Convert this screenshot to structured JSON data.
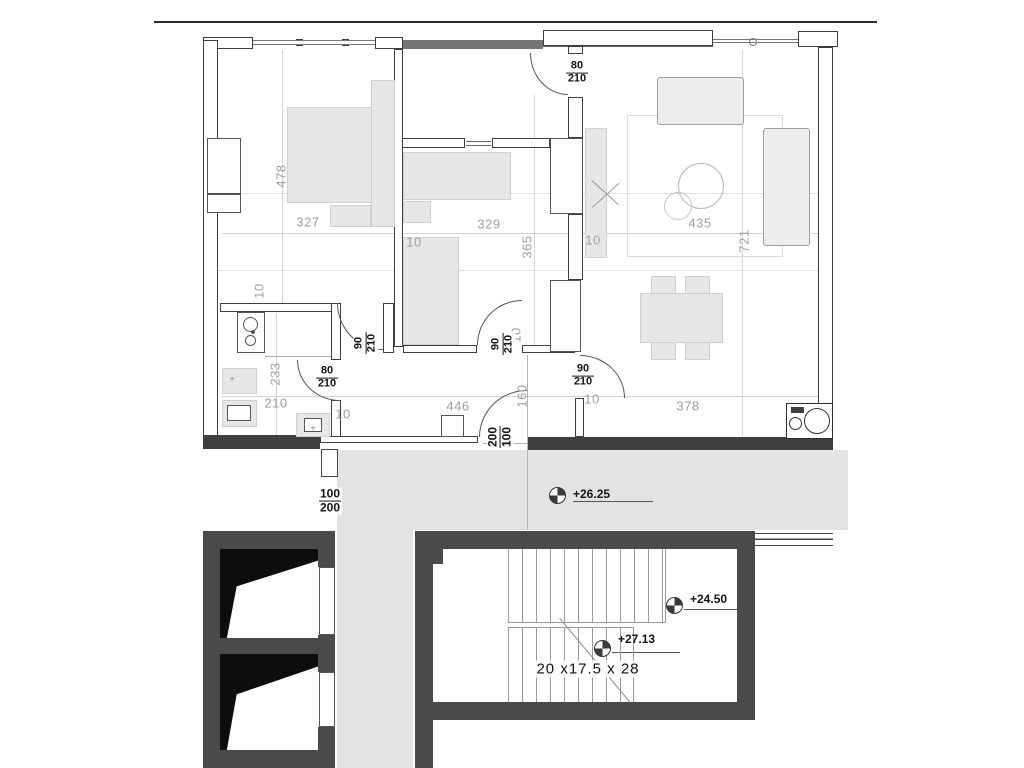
{
  "drawing": {
    "type": "apartment-floor-plan-with-staircase",
    "colors": {
      "background": "#ffffff",
      "wall_dark": "#4a4a4a",
      "wall_line": "#3d3d3d",
      "corridor_gray": "#e3e3e3",
      "furniture_gray": "#e7e7e7",
      "dim_text": "#9e9e9e",
      "label_text": "#141414"
    },
    "stair_text": "20 x17.5 x 28",
    "elevations": [
      "+26.25",
      "+24.50",
      "+27.13"
    ],
    "room_dimensions": [
      "478",
      "327",
      "329",
      "365",
      "435",
      "721",
      "233",
      "210",
      "446",
      "378",
      "160",
      "10"
    ],
    "door_sizes": [
      "80/210",
      "90/210"
    ],
    "window_sizes": [
      "100/200",
      "200/100"
    ]
  },
  "plan": {
    "areas": [
      [
        337,
        450,
        511,
        80
      ],
      [
        337,
        530,
        76,
        238
      ]
    ],
    "rects": [
      [
        "w",
        203,
        37,
        50,
        12
      ],
      [
        "w",
        375,
        37,
        28,
        12
      ],
      [
        "d2",
        403,
        40,
        140,
        9
      ],
      [
        "w",
        543,
        30,
        170,
        16
      ],
      [
        "w",
        798,
        31,
        40,
        16
      ],
      [
        "w",
        296,
        39,
        7,
        7
      ],
      [
        "w",
        342,
        39,
        7,
        7
      ],
      [
        "glz",
        253,
        40,
        122,
        5
      ],
      [
        "glz",
        713,
        39,
        85,
        4
      ],
      [
        "w",
        203,
        40,
        15,
        408
      ],
      [
        "w",
        818,
        47,
        15,
        390
      ],
      [
        "d3",
        203,
        435,
        117,
        14
      ],
      [
        "iw",
        320,
        436,
        158,
        7
      ],
      [
        "ow",
        441,
        415,
        23,
        22
      ],
      [
        "d3",
        528,
        437,
        305,
        13
      ],
      [
        "win3",
        321,
        449,
        17,
        28
      ],
      [
        "iw",
        394,
        49,
        9,
        298
      ],
      [
        "iw",
        220,
        303,
        118,
        9
      ],
      [
        "iw",
        383,
        303,
        11,
        50
      ],
      [
        "iw",
        403,
        345,
        74,
        8
      ],
      [
        "iw",
        522,
        345,
        53,
        8
      ],
      [
        "iw",
        568,
        46,
        15,
        8
      ],
      [
        "iw",
        568,
        97,
        15,
        41
      ],
      [
        "iw",
        568,
        214,
        15,
        66
      ],
      [
        "iw",
        575,
        398,
        9,
        39
      ],
      [
        "iw",
        402,
        138,
        63,
        10
      ],
      [
        "iw",
        492,
        138,
        58,
        10
      ],
      [
        "iw",
        331,
        303,
        10,
        57
      ],
      [
        "iw",
        331,
        400,
        10,
        37
      ],
      [
        "ow",
        237,
        312,
        28,
        41
      ],
      [
        "f",
        287,
        107,
        106,
        96
      ],
      [
        "f",
        371,
        80,
        24,
        147
      ],
      [
        "f",
        330,
        205,
        41,
        22
      ],
      [
        "ow",
        207,
        138,
        34,
        56
      ],
      [
        "ow",
        207,
        194,
        34,
        19
      ],
      [
        "f",
        403,
        152,
        108,
        48
      ],
      [
        "f",
        403,
        201,
        28,
        22
      ],
      [
        "f",
        403,
        237,
        56,
        108
      ],
      [
        "ow",
        550,
        138,
        33,
        76
      ],
      [
        "ow",
        550,
        280,
        31,
        72
      ],
      [
        "ol",
        627,
        115,
        156,
        142
      ],
      [
        "fo",
        657,
        77,
        87,
        48
      ],
      [
        "fo",
        763,
        128,
        47,
        118
      ],
      [
        "f",
        585,
        128,
        22,
        130
      ],
      [
        "f",
        640,
        293,
        83,
        50
      ],
      [
        "f",
        651,
        276,
        25,
        18
      ],
      [
        "f",
        685,
        276,
        25,
        18
      ],
      [
        "f",
        651,
        342,
        25,
        18
      ],
      [
        "f",
        685,
        342,
        25,
        18
      ],
      [
        "f",
        222,
        368,
        35,
        26
      ],
      [
        "f",
        222,
        400,
        35,
        27
      ],
      [
        "ow",
        227,
        405,
        24,
        16
      ],
      [
        "f",
        296,
        413,
        34,
        24
      ],
      [
        "ow",
        304,
        418,
        18,
        14
      ],
      [
        "ow2",
        786,
        403,
        47,
        36
      ],
      [
        "d3",
        791,
        407,
        13,
        6
      ],
      [
        "dk",
        203,
        531,
        132,
        18
      ],
      [
        "dk",
        203,
        549,
        17,
        219
      ],
      [
        "dk",
        203,
        638,
        132,
        16
      ],
      [
        "dk",
        203,
        750,
        132,
        18
      ],
      [
        "dk",
        318,
        549,
        17,
        18
      ],
      [
        "dk",
        318,
        635,
        17,
        37
      ],
      [
        "dk",
        318,
        727,
        17,
        41
      ],
      [
        "ow",
        319,
        567,
        16,
        68
      ],
      [
        "ow",
        319,
        672,
        16,
        55
      ],
      [
        "dk",
        415,
        531,
        340,
        18
      ],
      [
        "dk",
        415,
        549,
        18,
        219
      ],
      [
        "dk",
        737,
        549,
        18,
        171
      ],
      [
        "dk",
        415,
        702,
        340,
        18
      ],
      [
        "dk",
        433,
        549,
        10,
        15
      ],
      [
        "rail",
        755,
        533,
        78,
        13
      ]
    ],
    "flights": [
      [
        508,
        549,
        158,
        73
      ],
      [
        508,
        628,
        126,
        74
      ]
    ],
    "shafts": [
      [
        220,
        549,
        98,
        89
      ],
      [
        220,
        654,
        98,
        96
      ]
    ],
    "lines": [
      [
        154,
        21,
        723,
        2,
        "#2b2b2b"
      ],
      [
        203,
        193,
        630,
        1,
        "#e0e0e0"
      ],
      [
        203,
        270,
        630,
        1,
        "#e0e0e0"
      ],
      [
        222,
        233,
        596,
        1,
        "#d4d4d4"
      ],
      [
        222,
        396,
        596,
        1,
        "#d4d4d4"
      ],
      [
        282,
        50,
        1,
        253,
        "#d4d4d4"
      ],
      [
        534,
        95,
        1,
        250,
        "#d4d4d4"
      ],
      [
        742,
        50,
        1,
        385,
        "#d4d4d4"
      ],
      [
        276,
        313,
        1,
        122,
        "#d4d4d4"
      ],
      [
        527,
        355,
        1,
        175,
        "#b5b5b5"
      ],
      [
        329,
        450,
        1,
        26,
        "#555"
      ],
      [
        210,
        49,
        1,
        396,
        "#999"
      ],
      [
        543,
        46,
        170,
        1,
        "#666"
      ],
      [
        466,
        141,
        25,
        1,
        "#666"
      ],
      [
        466,
        145,
        25,
        1,
        "#666"
      ],
      [
        551,
        175,
        31,
        1,
        "#888"
      ],
      [
        700,
        80,
        1,
        42,
        "#b5b5b5"
      ],
      [
        763,
        167,
        44,
        1,
        "#b5b5b5"
      ],
      [
        763,
        206,
        44,
        1,
        "#b5b5b5"
      ],
      [
        404,
        318,
        54,
        1,
        "#cccccc"
      ],
      [
        265,
        356,
        66,
        1,
        "#aaaaaa"
      ],
      [
        592,
        155,
        2,
        68,
        "#777"
      ],
      [
        508,
        622,
        158,
        1,
        "#9a9a9a"
      ],
      [
        508,
        627,
        126,
        1,
        "#9a9a9a"
      ],
      [
        573,
        501,
        80,
        1,
        "#555"
      ],
      [
        684,
        609,
        53,
        1,
        "#555"
      ],
      [
        612,
        652,
        68,
        1,
        "#555"
      ],
      [
        483,
        443,
        45,
        1,
        "#b5b5b5"
      ],
      [
        326,
        568,
        1,
        66,
        "#555"
      ],
      [
        326,
        673,
        1,
        53,
        "#555"
      ]
    ],
    "rot_lines": [
      [
        560,
        618,
        110,
        50,
        "#8a8a8a"
      ],
      [
        592,
        180,
        36,
        42,
        "#999"
      ],
      [
        592,
        207,
        36,
        -42,
        "#999"
      ]
    ],
    "circles": [
      [
        678,
        163,
        46,
        "#b8b8b8"
      ],
      [
        664,
        192,
        28,
        "#c5c5c5"
      ],
      [
        243,
        317,
        15,
        "#555"
      ],
      [
        245,
        335,
        11,
        "#555"
      ],
      [
        251,
        330,
        4,
        "#555",
        "#555"
      ],
      [
        749,
        38,
        8,
        "#777"
      ],
      [
        804,
        408,
        26,
        "#333"
      ],
      [
        789,
        417,
        13,
        "#333"
      ]
    ],
    "arcs": [
      [
        530,
        53,
        38,
        42,
        "bl"
      ],
      [
        337,
        303,
        46,
        47,
        "bl"
      ],
      [
        297,
        360,
        43,
        41,
        "bl"
      ],
      [
        477,
        300,
        45,
        45,
        "tl"
      ],
      [
        479,
        390,
        48,
        47,
        "tl"
      ],
      [
        580,
        355,
        45,
        43,
        "tr"
      ]
    ],
    "markers": [
      [
        549,
        487
      ],
      [
        666,
        597
      ],
      [
        594,
        640
      ]
    ],
    "labels": [
      {
        "t": "478",
        "x": 281,
        "y": 176,
        "r": 1
      },
      {
        "t": "327",
        "x": 308,
        "y": 222
      },
      {
        "t": "329",
        "x": 489,
        "y": 224
      },
      {
        "t": "365",
        "x": 527,
        "y": 247,
        "r": 1
      },
      {
        "t": "435",
        "x": 700,
        "y": 223
      },
      {
        "t": "721",
        "x": 744,
        "y": 241,
        "r": 1
      },
      {
        "t": "233",
        "x": 275,
        "y": 374,
        "r": 1
      },
      {
        "t": "210",
        "x": 276,
        "y": 403
      },
      {
        "t": "446",
        "x": 458,
        "y": 406
      },
      {
        "t": "378",
        "x": 688,
        "y": 406
      },
      {
        "t": "160",
        "x": 522,
        "y": 396,
        "r": 1
      },
      {
        "t": "10",
        "x": 259,
        "y": 291,
        "r": 1
      },
      {
        "t": "10",
        "x": 414,
        "y": 242
      },
      {
        "t": "10",
        "x": 593,
        "y": 240
      },
      {
        "t": "10",
        "x": 516,
        "y": 335,
        "r": 1
      },
      {
        "t": "10",
        "x": 343,
        "y": 414
      },
      {
        "t": "10",
        "x": 592,
        "y": 399
      },
      {
        "t": "+",
        "x": 232,
        "y": 380,
        "c": "plus"
      },
      {
        "t": "+",
        "x": 313,
        "y": 429,
        "c": "plus"
      }
    ],
    "fracs": [
      {
        "a": "80",
        "b": "210",
        "x": 577,
        "y": 73
      },
      {
        "a": "80",
        "b": "210",
        "x": 327,
        "y": 378
      },
      {
        "a": "90",
        "b": "210",
        "x": 366,
        "y": 343,
        "r": 1
      },
      {
        "a": "90",
        "b": "210",
        "x": 503,
        "y": 344,
        "r": 1
      },
      {
        "a": "90",
        "b": "210",
        "x": 583,
        "y": 376
      },
      {
        "a": "100",
        "b": "200",
        "x": 330,
        "y": 501,
        "win": 1
      },
      {
        "a": "200",
        "b": "100",
        "x": 500,
        "y": 437,
        "r": 1,
        "win": 1
      }
    ]
  }
}
